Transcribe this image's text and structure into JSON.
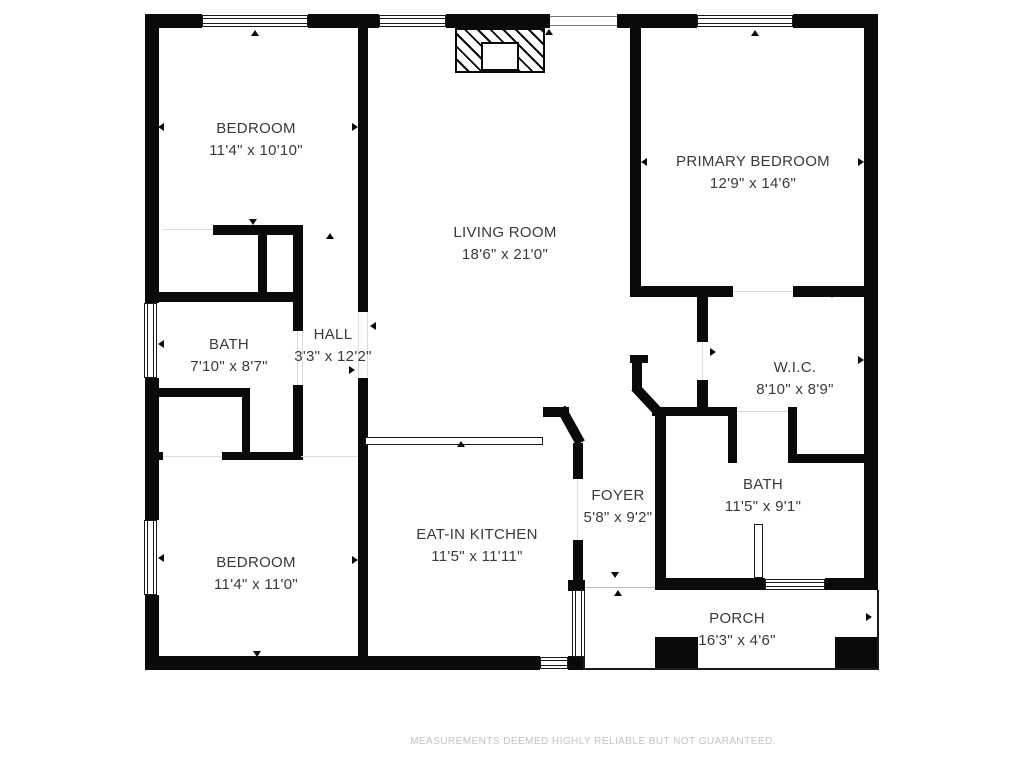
{
  "page": {
    "background": "#ffffff"
  },
  "colors": {
    "wall": "#0a0a0a",
    "label_text": "#3a3a3a",
    "footer_text": "#c3c3c3"
  },
  "rooms": [
    {
      "id": "bedroom-1",
      "name": "BEDROOM",
      "dims": "11'4\" x 10'10\""
    },
    {
      "id": "living-room",
      "name": "LIVING ROOM",
      "dims": "18'6\" x 21'0\""
    },
    {
      "id": "primary-bedroom",
      "name": "PRIMARY BEDROOM",
      "dims": "12'9\" x 14'6\""
    },
    {
      "id": "bath-1",
      "name": "BATH",
      "dims": "7'10\" x 8'7\""
    },
    {
      "id": "hall",
      "name": "HALL",
      "dims": "3'3\" x 12'2\""
    },
    {
      "id": "wic",
      "name": "W.I.C.",
      "dims": "8'10\" x 8'9\""
    },
    {
      "id": "bath-2",
      "name": "BATH",
      "dims": "11'5\" x 9'1\""
    },
    {
      "id": "foyer",
      "name": "FOYER",
      "dims": "5'8\" x 9'2\""
    },
    {
      "id": "eat-in-kitchen",
      "name": "EAT-IN KITCHEN",
      "dims": "11'5\" x 11'11\""
    },
    {
      "id": "bedroom-2",
      "name": "BEDROOM",
      "dims": "11'4\" x 11'0\""
    },
    {
      "id": "porch",
      "name": "PORCH",
      "dims": "16'3\" x 4'6\""
    }
  ],
  "icons": {
    "door_marker": "small black triangle"
  },
  "footer": {
    "disclaimer": "MEASUREMENTS DEEMED HIGHLY RELIABLE BUT NOT GUARANTEED."
  }
}
